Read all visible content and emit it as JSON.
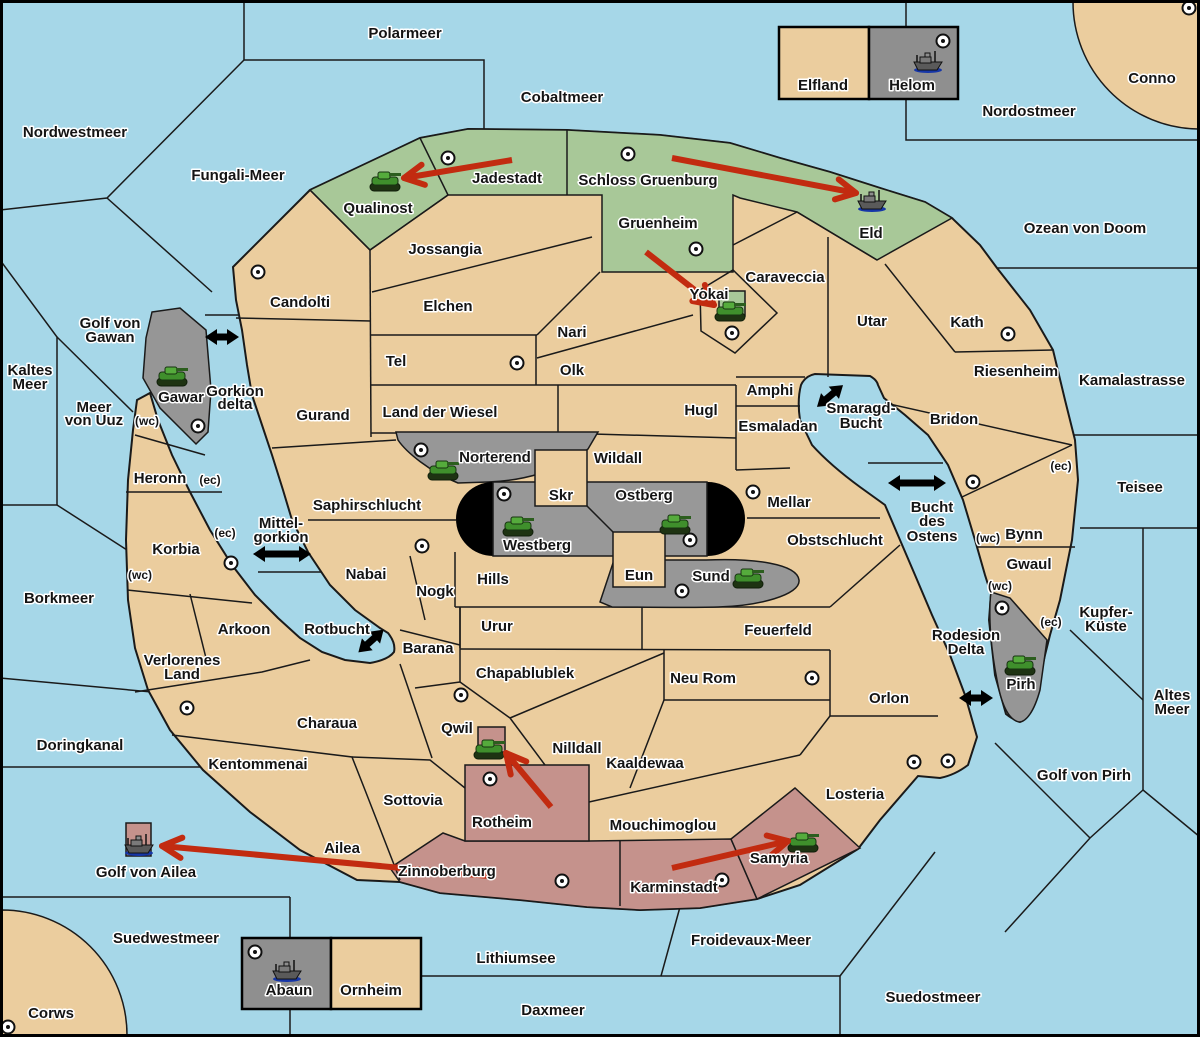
{
  "colors": {
    "sea": "#A6D7E8",
    "land": "#EBCD9E",
    "green_zone": "#A8C898",
    "gray_zone": "#969696",
    "pink_zone": "#C5928C",
    "black_zone": "#000000",
    "attack_arrow": "#C22B10",
    "waterway_arrow": "#000000",
    "border": "#1A1A1A"
  },
  "labels": [
    {
      "text": "Polarmeer",
      "x": 405,
      "y": 38,
      "kind": "sea"
    },
    {
      "text": "Nordwestmeer",
      "x": 75,
      "y": 137,
      "kind": "sea"
    },
    {
      "text": "Fungali-Meer",
      "x": 238,
      "y": 180,
      "kind": "sea"
    },
    {
      "text": "Cobaltmeer",
      "x": 562,
      "y": 102,
      "kind": "sea"
    },
    {
      "text": "Nordostmeer",
      "x": 1029,
      "y": 116,
      "kind": "sea"
    },
    {
      "text": "Conno",
      "x": 1152,
      "y": 83,
      "kind": "territory"
    },
    {
      "text": "Ozean von Doom",
      "x": 1085,
      "y": 233,
      "kind": "sea"
    },
    {
      "text": "Kamalastrasse",
      "x": 1132,
      "y": 385,
      "kind": "sea"
    },
    {
      "text": "Kaltes",
      "x": 30,
      "y": 375,
      "kind": "sea"
    },
    {
      "text": "Meer",
      "x": 30,
      "y": 389,
      "kind": "sea"
    },
    {
      "text": "Golf von",
      "x": 110,
      "y": 328,
      "kind": "sea"
    },
    {
      "text": "Gawan",
      "x": 110,
      "y": 342,
      "kind": "sea"
    },
    {
      "text": "Meer",
      "x": 94,
      "y": 412,
      "kind": "sea"
    },
    {
      "text": "von Uuz",
      "x": 94,
      "y": 425,
      "kind": "sea"
    },
    {
      "text": "Gorkion",
      "x": 235,
      "y": 396,
      "kind": "sea"
    },
    {
      "text": "delta",
      "x": 235,
      "y": 409,
      "kind": "sea"
    },
    {
      "text": "Mittel-",
      "x": 281,
      "y": 528,
      "kind": "sea"
    },
    {
      "text": "gorkion",
      "x": 281,
      "y": 542,
      "kind": "sea"
    },
    {
      "text": "Borkmeer",
      "x": 59,
      "y": 603,
      "kind": "sea"
    },
    {
      "text": "Rotbucht",
      "x": 337,
      "y": 634,
      "kind": "sea"
    },
    {
      "text": "Doringkanal",
      "x": 80,
      "y": 750,
      "kind": "sea"
    },
    {
      "text": "Golf von Ailea",
      "x": 146,
      "y": 877,
      "kind": "sea"
    },
    {
      "text": "Suedwestmeer",
      "x": 166,
      "y": 943,
      "kind": "sea"
    },
    {
      "text": "Corws",
      "x": 51,
      "y": 1018,
      "kind": "territory"
    },
    {
      "text": "Lithiumsee",
      "x": 516,
      "y": 963,
      "kind": "sea"
    },
    {
      "text": "Daxmeer",
      "x": 553,
      "y": 1015,
      "kind": "sea"
    },
    {
      "text": "Froidevaux-Meer",
      "x": 751,
      "y": 945,
      "kind": "sea"
    },
    {
      "text": "Suedostmeer",
      "x": 933,
      "y": 1002,
      "kind": "sea"
    },
    {
      "text": "Golf von Pirh",
      "x": 1084,
      "y": 780,
      "kind": "sea"
    },
    {
      "text": "Altes",
      "x": 1172,
      "y": 700,
      "kind": "sea"
    },
    {
      "text": "Meer",
      "x": 1172,
      "y": 714,
      "kind": "sea"
    },
    {
      "text": "Kupfer-",
      "x": 1106,
      "y": 617,
      "kind": "sea"
    },
    {
      "text": "Küste",
      "x": 1106,
      "y": 631,
      "kind": "sea"
    },
    {
      "text": "Teisee",
      "x": 1140,
      "y": 492,
      "kind": "sea"
    },
    {
      "text": "Smaragd-",
      "x": 861,
      "y": 413,
      "kind": "sea"
    },
    {
      "text": "Bucht",
      "x": 861,
      "y": 428,
      "kind": "sea"
    },
    {
      "text": "Bucht",
      "x": 932,
      "y": 512,
      "kind": "sea"
    },
    {
      "text": "des",
      "x": 932,
      "y": 526,
      "kind": "sea"
    },
    {
      "text": "Ostens",
      "x": 932,
      "y": 541,
      "kind": "sea"
    },
    {
      "text": "Rodesion",
      "x": 966,
      "y": 640,
      "kind": "sea"
    },
    {
      "text": "Delta",
      "x": 966,
      "y": 654,
      "kind": "sea"
    },
    {
      "text": "Qualinost",
      "x": 378,
      "y": 213,
      "kind": "territory"
    },
    {
      "text": "Jadestadt",
      "x": 507,
      "y": 183,
      "kind": "territory"
    },
    {
      "text": "Schloss Gruenburg",
      "x": 648,
      "y": 185,
      "kind": "territory"
    },
    {
      "text": "Eld",
      "x": 871,
      "y": 238,
      "kind": "territory"
    },
    {
      "text": "Gruenheim",
      "x": 658,
      "y": 228,
      "kind": "territory"
    },
    {
      "text": "Elfland",
      "x": 823,
      "y": 90,
      "kind": "territory"
    },
    {
      "text": "Helom",
      "x": 912,
      "y": 90,
      "kind": "territory"
    },
    {
      "text": "Candolti",
      "x": 300,
      "y": 307,
      "kind": "territory"
    },
    {
      "text": "Jossangia",
      "x": 445,
      "y": 254,
      "kind": "territory"
    },
    {
      "text": "Elchen",
      "x": 448,
      "y": 311,
      "kind": "territory"
    },
    {
      "text": "Nari",
      "x": 572,
      "y": 337,
      "kind": "territory"
    },
    {
      "text": "Tel",
      "x": 396,
      "y": 366,
      "kind": "territory"
    },
    {
      "text": "Olk",
      "x": 572,
      "y": 375,
      "kind": "territory"
    },
    {
      "text": "Yokai",
      "x": 709,
      "y": 299,
      "kind": "territory"
    },
    {
      "text": "Caraveccia",
      "x": 785,
      "y": 282,
      "kind": "territory"
    },
    {
      "text": "Utar",
      "x": 872,
      "y": 326,
      "kind": "territory"
    },
    {
      "text": "Kath",
      "x": 967,
      "y": 327,
      "kind": "territory"
    },
    {
      "text": "Riesenheim",
      "x": 1016,
      "y": 376,
      "kind": "territory"
    },
    {
      "text": "Bridon",
      "x": 954,
      "y": 424,
      "kind": "territory"
    },
    {
      "text": "Gurand",
      "x": 323,
      "y": 420,
      "kind": "territory"
    },
    {
      "text": "Land der Wiesel",
      "x": 440,
      "y": 417,
      "kind": "territory"
    },
    {
      "text": "Hugl",
      "x": 701,
      "y": 415,
      "kind": "territory"
    },
    {
      "text": "Amphi",
      "x": 770,
      "y": 395,
      "kind": "territory"
    },
    {
      "text": "Esmaladan",
      "x": 778,
      "y": 431,
      "kind": "territory"
    },
    {
      "text": "Gawar",
      "x": 181,
      "y": 402,
      "kind": "territory"
    },
    {
      "text": "Norterend",
      "x": 495,
      "y": 462,
      "kind": "territory"
    },
    {
      "text": "Wildall",
      "x": 618,
      "y": 463,
      "kind": "territory"
    },
    {
      "text": "Skr",
      "x": 561,
      "y": 500,
      "kind": "territory"
    },
    {
      "text": "Ostberg",
      "x": 644,
      "y": 500,
      "kind": "territory"
    },
    {
      "text": "Westberg",
      "x": 537,
      "y": 550,
      "kind": "territory"
    },
    {
      "text": "Eun",
      "x": 639,
      "y": 580,
      "kind": "territory"
    },
    {
      "text": "Sund",
      "x": 711,
      "y": 581,
      "kind": "territory"
    },
    {
      "text": "Mellar",
      "x": 789,
      "y": 507,
      "kind": "territory"
    },
    {
      "text": "Obstschlucht",
      "x": 835,
      "y": 545,
      "kind": "territory"
    },
    {
      "text": "Saphirschlucht",
      "x": 367,
      "y": 510,
      "kind": "territory"
    },
    {
      "text": "Heronn",
      "x": 160,
      "y": 483,
      "kind": "territory"
    },
    {
      "text": "Korbia",
      "x": 176,
      "y": 554,
      "kind": "territory"
    },
    {
      "text": "Nabai",
      "x": 366,
      "y": 579,
      "kind": "territory"
    },
    {
      "text": "Nogk",
      "x": 435,
      "y": 596,
      "kind": "territory"
    },
    {
      "text": "Hills",
      "x": 493,
      "y": 584,
      "kind": "territory"
    },
    {
      "text": "Urur",
      "x": 497,
      "y": 631,
      "kind": "territory"
    },
    {
      "text": "Feuerfeld",
      "x": 778,
      "y": 635,
      "kind": "territory"
    },
    {
      "text": "Chapablublek",
      "x": 525,
      "y": 678,
      "kind": "territory"
    },
    {
      "text": "Neu Rom",
      "x": 703,
      "y": 683,
      "kind": "territory"
    },
    {
      "text": "Orlon",
      "x": 889,
      "y": 703,
      "kind": "territory"
    },
    {
      "text": "Arkoon",
      "x": 244,
      "y": 634,
      "kind": "territory"
    },
    {
      "text": "Barana",
      "x": 428,
      "y": 653,
      "kind": "territory"
    },
    {
      "text": "Verlorenes",
      "x": 182,
      "y": 665,
      "kind": "territory"
    },
    {
      "text": "Land",
      "x": 182,
      "y": 679,
      "kind": "territory"
    },
    {
      "text": "Charaua",
      "x": 327,
      "y": 728,
      "kind": "territory"
    },
    {
      "text": "Kentommenai",
      "x": 258,
      "y": 769,
      "kind": "territory"
    },
    {
      "text": "Sottovia",
      "x": 413,
      "y": 805,
      "kind": "territory"
    },
    {
      "text": "Ailea",
      "x": 342,
      "y": 853,
      "kind": "territory"
    },
    {
      "text": "Qwil",
      "x": 457,
      "y": 733,
      "kind": "territory"
    },
    {
      "text": "Nilldall",
      "x": 577,
      "y": 753,
      "kind": "territory"
    },
    {
      "text": "Kaaldewaa",
      "x": 645,
      "y": 768,
      "kind": "territory"
    },
    {
      "text": "Rotheim",
      "x": 502,
      "y": 827,
      "kind": "territory"
    },
    {
      "text": "Mouchimoglou",
      "x": 663,
      "y": 830,
      "kind": "territory"
    },
    {
      "text": "Zinnoberburg",
      "x": 447,
      "y": 876,
      "kind": "territory"
    },
    {
      "text": "Karminstadt",
      "x": 674,
      "y": 892,
      "kind": "territory"
    },
    {
      "text": "Samyria",
      "x": 779,
      "y": 863,
      "kind": "territory"
    },
    {
      "text": "Losteria",
      "x": 855,
      "y": 799,
      "kind": "territory"
    },
    {
      "text": "Pirh",
      "x": 1021,
      "y": 689,
      "kind": "territory"
    },
    {
      "text": "Bynn",
      "x": 1024,
      "y": 539,
      "kind": "territory"
    },
    {
      "text": "Gwaul",
      "x": 1029,
      "y": 569,
      "kind": "territory"
    },
    {
      "text": "Abaun",
      "x": 289,
      "y": 995,
      "kind": "territory"
    },
    {
      "text": "Ornheim",
      "x": 371,
      "y": 995,
      "kind": "territory"
    },
    {
      "text": "(wc)",
      "x": 147,
      "y": 425,
      "kind": "marker"
    },
    {
      "text": "(ec)",
      "x": 210,
      "y": 484,
      "kind": "marker"
    },
    {
      "text": "(ec)",
      "x": 225,
      "y": 537,
      "kind": "marker"
    },
    {
      "text": "(wc)",
      "x": 140,
      "y": 579,
      "kind": "marker"
    },
    {
      "text": "(ec)",
      "x": 1061,
      "y": 470,
      "kind": "marker"
    },
    {
      "text": "(wc)",
      "x": 988,
      "y": 542,
      "kind": "marker"
    },
    {
      "text": "(wc)",
      "x": 1000,
      "y": 590,
      "kind": "marker"
    },
    {
      "text": "(ec)",
      "x": 1051,
      "y": 626,
      "kind": "marker"
    }
  ],
  "city_dots": [
    [
      448,
      158
    ],
    [
      628,
      154
    ],
    [
      943,
      41
    ],
    [
      1189,
      8
    ],
    [
      258,
      272
    ],
    [
      696,
      249
    ],
    [
      732,
      333
    ],
    [
      1008,
      334
    ],
    [
      517,
      363
    ],
    [
      198,
      426
    ],
    [
      421,
      450
    ],
    [
      504,
      494
    ],
    [
      690,
      540
    ],
    [
      682,
      591
    ],
    [
      753,
      492
    ],
    [
      973,
      482
    ],
    [
      1002,
      608
    ],
    [
      231,
      563
    ],
    [
      187,
      708
    ],
    [
      461,
      695
    ],
    [
      812,
      678
    ],
    [
      490,
      779
    ],
    [
      562,
      881
    ],
    [
      722,
      880
    ],
    [
      914,
      762
    ],
    [
      948,
      761
    ],
    [
      255,
      952
    ],
    [
      8,
      1027
    ],
    [
      422,
      546
    ]
  ],
  "units": {
    "tanks": [
      {
        "territory": "Qualinost",
        "x": 385,
        "y": 181
      },
      {
        "territory": "Gawar",
        "x": 172,
        "y": 376
      },
      {
        "territory": "Yokai",
        "x": 730,
        "y": 311
      },
      {
        "territory": "Norterend",
        "x": 443,
        "y": 470
      },
      {
        "territory": "Westberg",
        "x": 518,
        "y": 526
      },
      {
        "territory": "Ostberg",
        "x": 675,
        "y": 524
      },
      {
        "territory": "Sund",
        "x": 748,
        "y": 578
      },
      {
        "territory": "Qwil",
        "x": 489,
        "y": 749
      },
      {
        "territory": "Samyria",
        "x": 803,
        "y": 842
      },
      {
        "territory": "Pirh",
        "x": 1020,
        "y": 665
      }
    ],
    "ships": [
      {
        "territory": "Helom",
        "x": 928,
        "y": 62
      },
      {
        "territory": "Eld",
        "x": 872,
        "y": 201
      },
      {
        "territory": "Golf von Ailea",
        "x": 139,
        "y": 845
      },
      {
        "territory": "Abaun",
        "x": 287,
        "y": 971
      }
    ]
  },
  "attack_arrows": [
    {
      "from": "Jadestadt",
      "to": "Qualinost",
      "x1": 512,
      "y1": 160,
      "x2": 404,
      "y2": 178
    },
    {
      "from": "Schloss Gruenburg",
      "to": "Eld",
      "x1": 672,
      "y1": 158,
      "x2": 856,
      "y2": 193
    },
    {
      "from": "Gruenheim",
      "to": "Yokai",
      "x1": 646,
      "y1": 252,
      "x2": 714,
      "y2": 305
    },
    {
      "from": "Rotheim",
      "to": "Qwil",
      "x1": 551,
      "y1": 807,
      "x2": 506,
      "y2": 753
    },
    {
      "from": "Karminstadt",
      "to": "Samyria",
      "x1": 672,
      "y1": 868,
      "x2": 788,
      "y2": 841
    },
    {
      "from": "Zinnoberburg",
      "to": "Golf von Ailea",
      "x1": 489,
      "y1": 876,
      "x2": 162,
      "y2": 846
    }
  ],
  "waterway_arrows": [
    {
      "at": "Gorkion delta",
      "x": 222,
      "y": 337,
      "angle": 0,
      "len": 34
    },
    {
      "at": "Smaragd-Bucht",
      "x": 830,
      "y": 396,
      "angle": -40,
      "len": 34
    },
    {
      "at": "Bucht des Ostens",
      "x": 917,
      "y": 483,
      "angle": 0,
      "len": 58
    },
    {
      "at": "Mittel-gorkion",
      "x": 282,
      "y": 554,
      "angle": 0,
      "len": 58
    },
    {
      "at": "Rotbucht",
      "x": 371,
      "y": 641,
      "angle": -42,
      "len": 34
    },
    {
      "at": "Rodesion Delta",
      "x": 976,
      "y": 698,
      "angle": 0,
      "len": 34
    }
  ]
}
